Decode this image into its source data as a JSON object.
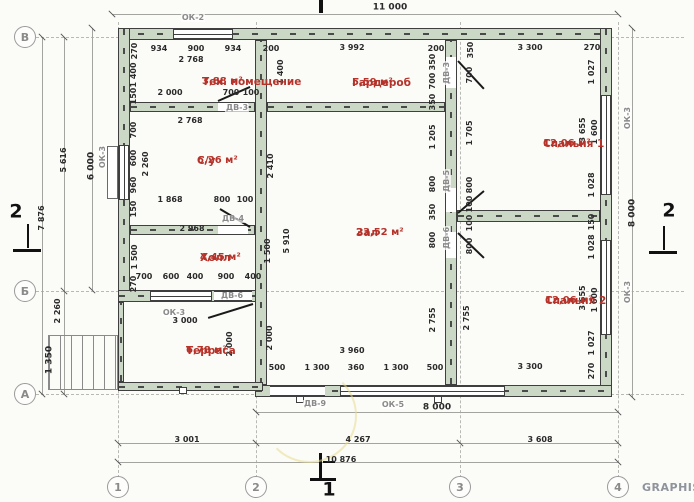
{
  "watermark": "GRAPHISO",
  "colors": {
    "wall_fill": "#ccd8c6",
    "room_text": "#b5332a",
    "dim_text": "#2b2b2b",
    "opening_tag_text": "#8a8a8a"
  },
  "plan": {
    "overall_dimensions": {
      "top_width": "11 000",
      "axis_width": "10 876",
      "right_height": "8 000",
      "left_height": "7 876"
    },
    "axis_markers": [
      {
        "label": "В",
        "x": 25,
        "y": 37
      },
      {
        "label": "Б",
        "x": 25,
        "y": 291
      },
      {
        "label": "А",
        "x": 25,
        "y": 394
      },
      {
        "label": "1",
        "x": 118,
        "y": 487
      },
      {
        "label": "2",
        "x": 256,
        "y": 487
      },
      {
        "label": "3",
        "x": 460,
        "y": 487
      },
      {
        "label": "4",
        "x": 618,
        "y": 487
      }
    ],
    "rooms": [
      {
        "name": "Тех. помещение",
        "area": "3,88 м²",
        "x": 202,
        "y": 76
      },
      {
        "name": "Гардероб",
        "area": "5,59 м²",
        "x": 352,
        "y": 77
      },
      {
        "name": "Спальня 1",
        "area": "12,06 м²",
        "x": 543,
        "y": 138
      },
      {
        "name": "С/у",
        "area": "6,26 м²",
        "x": 197,
        "y": 155
      },
      {
        "name": "Зал",
        "area": "23,52 м²",
        "x": 356,
        "y": 227
      },
      {
        "name": "Холл",
        "area": "4,45 м²",
        "x": 200,
        "y": 252
      },
      {
        "name": "Спальня 2",
        "area": "12,06 м²",
        "x": 545,
        "y": 295
      },
      {
        "name": "Терраса",
        "area": "6,78 м²",
        "x": 186,
        "y": 345
      }
    ],
    "labels": [
      {
        "t": "11 000",
        "x": 390,
        "y": 8,
        "o": "h",
        "k": "dimb"
      },
      {
        "t": "ОК-2",
        "x": 193,
        "y": 18,
        "o": "h",
        "k": "tag"
      },
      {
        "t": "270",
        "x": 135,
        "y": 51,
        "o": "v",
        "k": "dim"
      },
      {
        "t": "934",
        "x": 159,
        "y": 49,
        "o": "h",
        "k": "dim"
      },
      {
        "t": "900",
        "x": 196,
        "y": 49,
        "o": "h",
        "k": "dim"
      },
      {
        "t": "934",
        "x": 233,
        "y": 49,
        "o": "h",
        "k": "dim"
      },
      {
        "t": "200",
        "x": 271,
        "y": 49,
        "o": "h",
        "k": "dim"
      },
      {
        "t": "3 992",
        "x": 352,
        "y": 48,
        "o": "h",
        "k": "dim"
      },
      {
        "t": "200",
        "x": 436,
        "y": 49,
        "o": "h",
        "k": "dim"
      },
      {
        "t": "350",
        "x": 471,
        "y": 50,
        "o": "v",
        "k": "dim"
      },
      {
        "t": "3 300",
        "x": 530,
        "y": 48,
        "o": "h",
        "k": "dim"
      },
      {
        "t": "270",
        "x": 592,
        "y": 48,
        "o": "h",
        "k": "dim"
      },
      {
        "t": "2 768",
        "x": 191,
        "y": 60,
        "o": "h",
        "k": "dim"
      },
      {
        "t": "1 400",
        "x": 134,
        "y": 75,
        "o": "v",
        "k": "dim"
      },
      {
        "t": "150",
        "x": 134,
        "y": 96,
        "o": "v",
        "k": "dim"
      },
      {
        "t": "2 000",
        "x": 170,
        "y": 93,
        "o": "h",
        "k": "dim"
      },
      {
        "t": "700",
        "x": 231,
        "y": 93,
        "o": "h",
        "k": "dim"
      },
      {
        "t": "100",
        "x": 251,
        "y": 93,
        "o": "h",
        "k": "dim"
      },
      {
        "t": "ДВ-3",
        "x": 237,
        "y": 108,
        "o": "h",
        "k": "tag"
      },
      {
        "t": "1 400",
        "x": 281,
        "y": 72,
        "o": "v",
        "k": "dim"
      },
      {
        "t": "350",
        "x": 433,
        "y": 62,
        "o": "v",
        "k": "dim"
      },
      {
        "t": "700",
        "x": 433,
        "y": 81,
        "o": "v",
        "k": "dim"
      },
      {
        "t": "350",
        "x": 433,
        "y": 102,
        "o": "v",
        "k": "dim"
      },
      {
        "t": "ДВ-3",
        "x": 447,
        "y": 73,
        "o": "v",
        "k": "tag"
      },
      {
        "t": "700",
        "x": 470,
        "y": 75,
        "o": "v",
        "k": "dim"
      },
      {
        "t": "1 027",
        "x": 592,
        "y": 72,
        "o": "v",
        "k": "dim"
      },
      {
        "t": "1 205",
        "x": 433,
        "y": 137,
        "o": "v",
        "k": "dim"
      },
      {
        "t": "800",
        "x": 433,
        "y": 184,
        "o": "v",
        "k": "dim"
      },
      {
        "t": "350",
        "x": 433,
        "y": 212,
        "o": "v",
        "k": "dim"
      },
      {
        "t": "800",
        "x": 433,
        "y": 240,
        "o": "v",
        "k": "dim"
      },
      {
        "t": "1 705",
        "x": 470,
        "y": 133,
        "o": "v",
        "k": "dim"
      },
      {
        "t": "800",
        "x": 470,
        "y": 185,
        "o": "v",
        "k": "dim"
      },
      {
        "t": "100",
        "x": 470,
        "y": 204,
        "o": "v",
        "k": "dim"
      },
      {
        "t": "100",
        "x": 470,
        "y": 223,
        "o": "v",
        "k": "dim"
      },
      {
        "t": "800",
        "x": 470,
        "y": 246,
        "o": "v",
        "k": "dim"
      },
      {
        "t": "ДВ-5",
        "x": 447,
        "y": 181,
        "o": "v",
        "k": "tag"
      },
      {
        "t": "ДВ-6",
        "x": 447,
        "y": 238,
        "o": "v",
        "k": "tag"
      },
      {
        "t": "3 655",
        "x": 583,
        "y": 130,
        "o": "v",
        "k": "dim"
      },
      {
        "t": "1 600",
        "x": 595,
        "y": 132,
        "o": "v",
        "k": "dim"
      },
      {
        "t": "1 028",
        "x": 592,
        "y": 185,
        "o": "v",
        "k": "dim"
      },
      {
        "t": "150",
        "x": 592,
        "y": 222,
        "o": "v",
        "k": "dim"
      },
      {
        "t": "ОК-3",
        "x": 628,
        "y": 118,
        "o": "v",
        "k": "tag"
      },
      {
        "t": "8 000",
        "x": 633,
        "y": 213,
        "o": "v",
        "k": "dimb"
      },
      {
        "t": "2 768",
        "x": 190,
        "y": 121,
        "o": "h",
        "k": "dim"
      },
      {
        "t": "700",
        "x": 134,
        "y": 130,
        "o": "v",
        "k": "dim"
      },
      {
        "t": "600",
        "x": 134,
        "y": 158,
        "o": "v",
        "k": "dim"
      },
      {
        "t": "960",
        "x": 134,
        "y": 185,
        "o": "v",
        "k": "dim"
      },
      {
        "t": "150",
        "x": 134,
        "y": 209,
        "o": "v",
        "k": "dim"
      },
      {
        "t": "2 260",
        "x": 146,
        "y": 164,
        "o": "v",
        "k": "dim"
      },
      {
        "t": "1 868",
        "x": 170,
        "y": 200,
        "o": "h",
        "k": "dim"
      },
      {
        "t": "800",
        "x": 222,
        "y": 200,
        "o": "h",
        "k": "dim"
      },
      {
        "t": "100",
        "x": 245,
        "y": 200,
        "o": "h",
        "k": "dim"
      },
      {
        "t": "ДВ-4",
        "x": 233,
        "y": 219,
        "o": "h",
        "k": "tag"
      },
      {
        "t": "2 968",
        "x": 192,
        "y": 229,
        "o": "h",
        "k": "dim"
      },
      {
        "t": "1 500",
        "x": 135,
        "y": 257,
        "o": "v",
        "k": "dim"
      },
      {
        "t": "270",
        "x": 134,
        "y": 284,
        "o": "v",
        "k": "dim"
      },
      {
        "t": "700",
        "x": 144,
        "y": 277,
        "o": "h",
        "k": "dim"
      },
      {
        "t": "600",
        "x": 171,
        "y": 277,
        "o": "h",
        "k": "dim"
      },
      {
        "t": "400",
        "x": 195,
        "y": 277,
        "o": "h",
        "k": "dim"
      },
      {
        "t": "900",
        "x": 226,
        "y": 277,
        "o": "h",
        "k": "dim"
      },
      {
        "t": "400",
        "x": 253,
        "y": 277,
        "o": "h",
        "k": "dim"
      },
      {
        "t": "ДВ-6",
        "x": 232,
        "y": 296,
        "o": "h",
        "k": "tag"
      },
      {
        "t": "1 500",
        "x": 268,
        "y": 251,
        "o": "v",
        "k": "dim"
      },
      {
        "t": "2 410",
        "x": 271,
        "y": 166,
        "o": "v",
        "k": "dim"
      },
      {
        "t": "5 910",
        "x": 287,
        "y": 241,
        "o": "v",
        "k": "dim"
      },
      {
        "t": "2 000",
        "x": 270,
        "y": 338,
        "o": "v",
        "k": "dim"
      },
      {
        "t": "3 960",
        "x": 352,
        "y": 351,
        "o": "h",
        "k": "dim"
      },
      {
        "t": "500",
        "x": 277,
        "y": 368,
        "o": "h",
        "k": "dim"
      },
      {
        "t": "1 300",
        "x": 317,
        "y": 368,
        "o": "h",
        "k": "dim"
      },
      {
        "t": "360",
        "x": 356,
        "y": 368,
        "o": "h",
        "k": "dim"
      },
      {
        "t": "1 300",
        "x": 396,
        "y": 368,
        "o": "h",
        "k": "dim"
      },
      {
        "t": "500",
        "x": 435,
        "y": 368,
        "o": "h",
        "k": "dim"
      },
      {
        "t": "2 755",
        "x": 433,
        "y": 320,
        "o": "v",
        "k": "dim"
      },
      {
        "t": "2 755",
        "x": 467,
        "y": 318,
        "o": "v",
        "k": "dim"
      },
      {
        "t": "1 028",
        "x": 592,
        "y": 247,
        "o": "v",
        "k": "dim"
      },
      {
        "t": "3 655",
        "x": 583,
        "y": 298,
        "o": "v",
        "k": "dim"
      },
      {
        "t": "1 600",
        "x": 595,
        "y": 300,
        "o": "v",
        "k": "dim"
      },
      {
        "t": "1 027",
        "x": 592,
        "y": 343,
        "o": "v",
        "k": "dim"
      },
      {
        "t": "270",
        "x": 592,
        "y": 371,
        "o": "v",
        "k": "dim"
      },
      {
        "t": "3 300",
        "x": 530,
        "y": 367,
        "o": "h",
        "k": "dim"
      },
      {
        "t": "ОК-3",
        "x": 628,
        "y": 292,
        "o": "v",
        "k": "tag"
      },
      {
        "t": "ОК-3",
        "x": 174,
        "y": 313,
        "o": "h",
        "k": "tag"
      },
      {
        "t": "3 000",
        "x": 185,
        "y": 321,
        "o": "h",
        "k": "dim"
      },
      {
        "t": "2 000",
        "x": 230,
        "y": 344,
        "o": "v",
        "k": "dim"
      },
      {
        "t": "2 260",
        "x": 58,
        "y": 311,
        "o": "v",
        "k": "dim"
      },
      {
        "t": "1 350",
        "x": 50,
        "y": 360,
        "o": "v",
        "k": "dimb"
      },
      {
        "t": "7 876",
        "x": 42,
        "y": 218,
        "o": "v",
        "k": "dim"
      },
      {
        "t": "5 616",
        "x": 64,
        "y": 160,
        "o": "v",
        "k": "dim"
      },
      {
        "t": "6 000",
        "x": 92,
        "y": 166,
        "o": "v",
        "k": "dimb"
      },
      {
        "t": "ОК-3",
        "x": 103,
        "y": 157,
        "o": "v",
        "k": "tag"
      },
      {
        "t": "ДВ-9",
        "x": 315,
        "y": 404,
        "o": "h",
        "k": "tag"
      },
      {
        "t": "ОК-5",
        "x": 393,
        "y": 405,
        "o": "h",
        "k": "tag"
      },
      {
        "t": "8 000",
        "x": 437,
        "y": 408,
        "o": "h",
        "k": "dimb"
      },
      {
        "t": "3 001",
        "x": 187,
        "y": 440,
        "o": "h",
        "k": "dim"
      },
      {
        "t": "4 267",
        "x": 358,
        "y": 440,
        "o": "h",
        "k": "dim"
      },
      {
        "t": "3 608",
        "x": 540,
        "y": 440,
        "o": "h",
        "k": "dim"
      },
      {
        "t": "10 876",
        "x": 341,
        "y": 460,
        "o": "h",
        "k": "dim"
      },
      {
        "t": "1",
        "x": 329,
        "y": 490,
        "o": "h",
        "k": "sec"
      },
      {
        "t": "2",
        "x": 16,
        "y": 212,
        "o": "h",
        "k": "sec"
      },
      {
        "t": "2",
        "x": 669,
        "y": 211,
        "o": "h",
        "k": "sec"
      }
    ]
  }
}
